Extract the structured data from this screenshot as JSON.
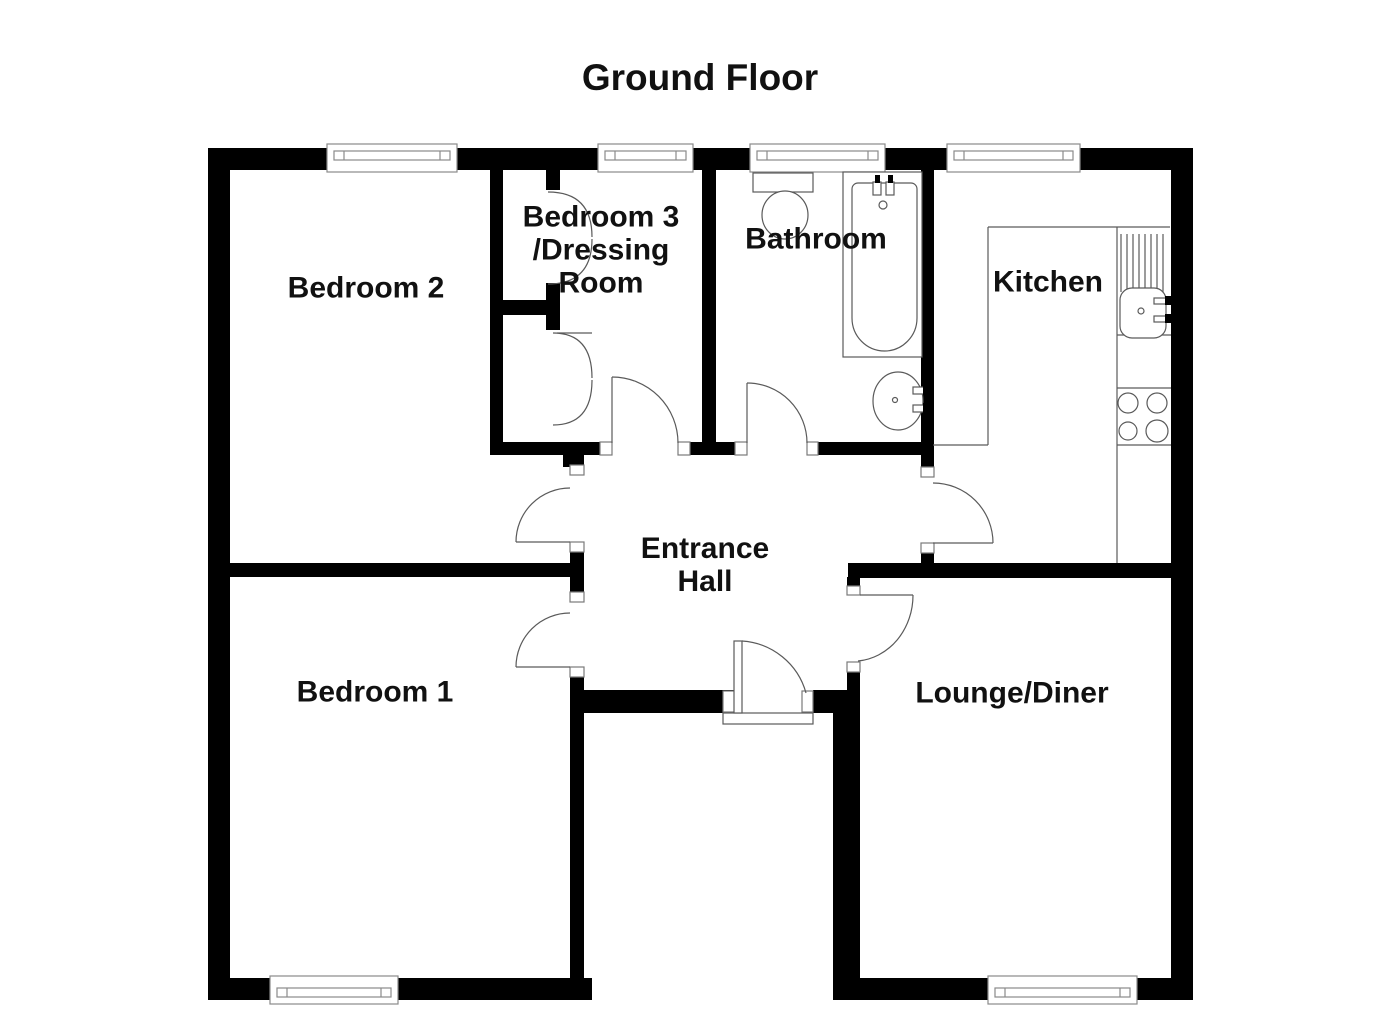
{
  "title": "Ground Floor",
  "title_pos": {
    "x": 700,
    "y": 78
  },
  "rooms": [
    {
      "id": "bedroom-2",
      "label": "Bedroom 2",
      "x": 366,
      "y": 288
    },
    {
      "id": "bedroom-3-dressing-room",
      "label": "Bedroom 3\n/Dressing\nRoom",
      "x": 601,
      "y": 250
    },
    {
      "id": "bathroom",
      "label": "Bathroom",
      "x": 816,
      "y": 239
    },
    {
      "id": "kitchen",
      "label": "Kitchen",
      "x": 1048,
      "y": 282
    },
    {
      "id": "entrance-hall",
      "label": "Entrance\nHall",
      "x": 705,
      "y": 565
    },
    {
      "id": "bedroom-1",
      "label": "Bedroom 1",
      "x": 375,
      "y": 692
    },
    {
      "id": "lounge-diner",
      "label": "Lounge/Diner",
      "x": 1012,
      "y": 693
    }
  ],
  "colors": {
    "wall": "#000000",
    "line": "#5a5a5a",
    "window_line": "#8a8a8a",
    "jamb_line": "#7a7a7a",
    "background": "#ffffff",
    "text": "#111111"
  },
  "plan": {
    "walls": [
      [
        208,
        148,
        985,
        22
      ],
      [
        208,
        148,
        22,
        852
      ],
      [
        1171,
        148,
        22,
        852
      ],
      [
        208,
        978,
        384,
        22
      ],
      [
        833,
        978,
        360,
        22
      ],
      [
        490,
        170,
        13,
        285
      ],
      [
        490,
        442,
        226,
        13
      ],
      [
        702,
        170,
        14,
        285
      ],
      [
        716,
        442,
        217,
        13
      ],
      [
        921,
        170,
        13,
        407
      ],
      [
        848,
        563,
        323,
        15
      ],
      [
        230,
        563,
        340,
        14
      ],
      [
        570,
        455,
        14,
        545
      ],
      [
        847,
        577,
        13,
        423
      ],
      [
        833,
        713,
        27,
        287
      ],
      [
        584,
        690,
        151,
        23
      ],
      [
        813,
        690,
        47,
        23
      ],
      [
        546,
        170,
        14,
        20
      ],
      [
        546,
        283,
        14,
        47
      ],
      [
        490,
        300,
        67,
        15
      ],
      [
        563,
        455,
        21,
        12
      ]
    ],
    "openings": [
      [
        612,
        442,
        66,
        13
      ],
      [
        747,
        442,
        60,
        13
      ],
      [
        921,
        477,
        13,
        66
      ],
      [
        847,
        595,
        13,
        67
      ],
      [
        570,
        475,
        14,
        67
      ],
      [
        570,
        602,
        14,
        65
      ]
    ],
    "jambs": [
      [
        600,
        442,
        12,
        13
      ],
      [
        678,
        442,
        12,
        13
      ],
      [
        735,
        442,
        12,
        13
      ],
      [
        807,
        442,
        11,
        13
      ],
      [
        921,
        467,
        13,
        10
      ],
      [
        921,
        543,
        13,
        10
      ],
      [
        847,
        586,
        13,
        9
      ],
      [
        847,
        662,
        13,
        10
      ],
      [
        570,
        465,
        14,
        10
      ],
      [
        570,
        542,
        14,
        10
      ],
      [
        570,
        592,
        14,
        10
      ],
      [
        570,
        667,
        14,
        10
      ],
      [
        723,
        691,
        12,
        21
      ],
      [
        802,
        691,
        11,
        21
      ]
    ],
    "windows": [
      {
        "x": 327,
        "w": 130,
        "side": "top"
      },
      {
        "x": 598,
        "w": 95,
        "side": "top"
      },
      {
        "x": 750,
        "w": 135,
        "side": "top"
      },
      {
        "x": 947,
        "w": 133,
        "side": "top"
      },
      {
        "x": 270,
        "w": 128,
        "side": "bottom"
      },
      {
        "x": 988,
        "w": 149,
        "side": "bottom"
      }
    ],
    "counter_lines": [
      [
        988,
        227,
        1170,
        227
      ],
      [
        988,
        227,
        988,
        445
      ],
      [
        933,
        445,
        988,
        445
      ],
      [
        1117,
        227,
        1117,
        563
      ],
      [
        1117,
        335,
        1171,
        335
      ],
      [
        1117,
        388,
        1171,
        388
      ],
      [
        1117,
        445,
        1171,
        445
      ]
    ],
    "drainboard": {
      "x_start": 1121,
      "step": 6,
      "count": 8,
      "y1": 234,
      "y2": 292
    },
    "doors": [
      {
        "name": "bedroom-2-door",
        "leaf": [
          516,
          542,
          570,
          542
        ],
        "arc": "M516,542 A54,54 0 0 1 570,488"
      },
      {
        "name": "bedroom-1-door",
        "leaf": [
          516,
          667,
          570,
          667
        ],
        "arc": "M516,667 A54,54 0 0 1 570,613"
      },
      {
        "name": "dressing-room-door",
        "leaf": [
          612,
          443,
          612,
          377
        ],
        "arc": "M612,377 A66,66 0 0 1 678,443"
      },
      {
        "name": "bathroom-door",
        "leaf": [
          747,
          443,
          747,
          383
        ],
        "arc": "M747,383 A60,60 0 0 1 807,443"
      },
      {
        "name": "kitchen-door",
        "leaf": [
          933,
          543,
          993,
          543
        ],
        "arc": "M993,543 A60,60 0 0 0 933,483"
      },
      {
        "name": "lounge-door",
        "leaf": [
          860,
          595,
          913,
          595
        ],
        "arc": "M913,595 A60,66 0 0 1 858,661"
      },
      {
        "name": "closet-door-upper-a",
        "leaf": null,
        "arc": "M548,192 Q592,192 592,237"
      },
      {
        "name": "closet-door-upper-b",
        "leaf": null,
        "arc": "M592,239 Q592,284 548,284"
      },
      {
        "name": "closet-door-lower-a",
        "leaf": [
          557,
          333,
          592,
          333
        ],
        "arc": "M553,333 Q592,333 592,378"
      },
      {
        "name": "closet-door-lower-b",
        "leaf": null,
        "arc": "M592,380 Q592,425 553,425"
      }
    ],
    "front_door": {
      "leaf_rect": [
        734,
        641,
        8,
        72
      ],
      "arc": "M742,641 A71,71 0 0 1 806,693",
      "threshold": [
        723,
        713,
        90,
        11
      ]
    },
    "fixtures": [
      {
        "type": "rect",
        "name": "toilet-tank",
        "x": 753,
        "y": 173,
        "w": 60,
        "h": 19
      },
      {
        "type": "ellipse",
        "name": "toilet-bowl",
        "cx": 785,
        "cy": 215,
        "rx": 23,
        "ry": 24
      },
      {
        "type": "rect",
        "name": "bathtub",
        "x": 843,
        "y": 172,
        "w": 79,
        "h": 185
      },
      {
        "type": "path",
        "name": "bathtub-interior",
        "d": "M852,189 a6,6 0 0 1 6,-6 h53 a6,6 0 0 1 6,6 v129 a32.5,33 0 0 1 -65,0 z"
      },
      {
        "type": "rect",
        "name": "bath-tap",
        "x": 873,
        "y": 182,
        "w": 8,
        "h": 13
      },
      {
        "type": "rect",
        "name": "bath-tap",
        "x": 886,
        "y": 182,
        "w": 8,
        "h": 13
      },
      {
        "type": "brect",
        "name": "bath-tap-tip",
        "x": 875,
        "y": 175,
        "w": 5,
        "h": 8
      },
      {
        "type": "brect",
        "name": "bath-tap-tip",
        "x": 888,
        "y": 175,
        "w": 5,
        "h": 8
      },
      {
        "type": "circle",
        "name": "bath-overflow",
        "cx": 883,
        "cy": 205,
        "r": 4
      },
      {
        "type": "ellipse",
        "name": "bathroom-basin",
        "cx": 898,
        "cy": 401,
        "rx": 25,
        "ry": 29
      },
      {
        "type": "circle",
        "name": "basin-drain",
        "cx": 895,
        "cy": 400,
        "r": 2.5
      },
      {
        "type": "rect",
        "name": "basin-tap",
        "x": 913,
        "y": 387,
        "w": 14,
        "h": 7
      },
      {
        "type": "rect",
        "name": "basin-tap",
        "x": 913,
        "y": 405,
        "w": 14,
        "h": 7
      },
      {
        "type": "brect",
        "name": "basin-tap-tip",
        "x": 923,
        "y": 385,
        "w": 7,
        "h": 10
      },
      {
        "type": "brect",
        "name": "basin-tap-tip",
        "x": 923,
        "y": 403,
        "w": 7,
        "h": 10
      },
      {
        "type": "rrect",
        "name": "kitchen-sink",
        "x": 1120,
        "y": 288,
        "w": 46,
        "h": 50,
        "rx": 12
      },
      {
        "type": "circle",
        "name": "sink-drain",
        "cx": 1141,
        "cy": 311,
        "r": 3
      },
      {
        "type": "rect",
        "name": "sink-tap",
        "x": 1154,
        "y": 298,
        "w": 14,
        "h": 6
      },
      {
        "type": "rect",
        "name": "sink-tap",
        "x": 1154,
        "y": 316,
        "w": 14,
        "h": 6
      },
      {
        "type": "brect",
        "name": "sink-tap-tip",
        "x": 1165,
        "y": 296,
        "w": 6,
        "h": 9
      },
      {
        "type": "brect",
        "name": "sink-tap-tip",
        "x": 1165,
        "y": 314,
        "w": 6,
        "h": 9
      },
      {
        "type": "circle",
        "name": "hob-ring",
        "cx": 1128,
        "cy": 403,
        "r": 10
      },
      {
        "type": "circle",
        "name": "hob-ring",
        "cx": 1157,
        "cy": 403,
        "r": 10
      },
      {
        "type": "circle",
        "name": "hob-ring",
        "cx": 1128,
        "cy": 431,
        "r": 9
      },
      {
        "type": "circle",
        "name": "hob-ring",
        "cx": 1157,
        "cy": 431,
        "r": 11
      }
    ]
  }
}
